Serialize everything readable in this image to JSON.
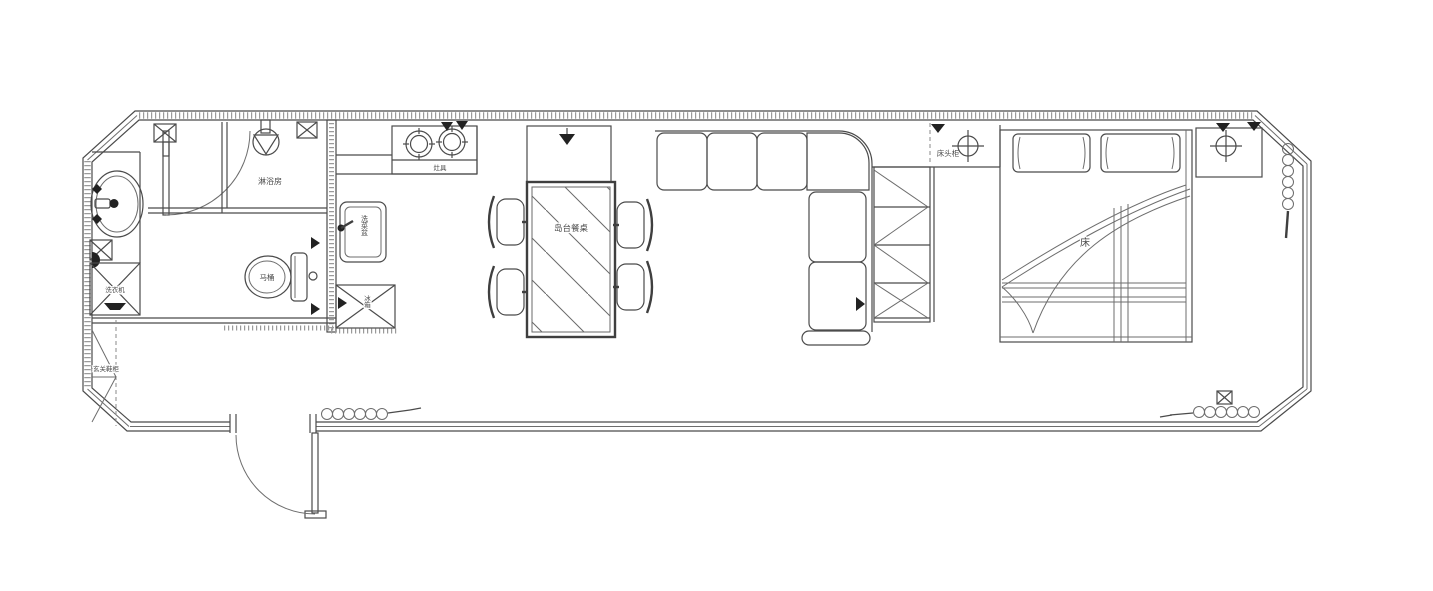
{
  "title": "apartment-floor-plan",
  "labels": {
    "shower_room": "淋浴房",
    "toilet": "马桶",
    "washing_machine": "洗衣机",
    "entry_cabinet": "玄关鞋柜",
    "stove": "灶具",
    "kitchen_sink": "洗菜盆",
    "fridge": "冰箱",
    "island_table": "岛台餐桌",
    "bedside_cabinet": "床头柜",
    "bed": "床"
  },
  "colors": {
    "line": "#4b4b4b",
    "line_dark": "#3f3f3f",
    "hatch": "#9a9a9a",
    "symbol_fill": "#222222",
    "background": "#ffffff"
  },
  "icons": {
    "ceiling_lamp": "crosshair-circle",
    "spotlight": "filled-triangle",
    "curtain": "coil-loops",
    "floor_drain": "circle-with-triangle",
    "appliance_box": "rect-x-cross",
    "wall_drain": "filled-half-circle"
  }
}
